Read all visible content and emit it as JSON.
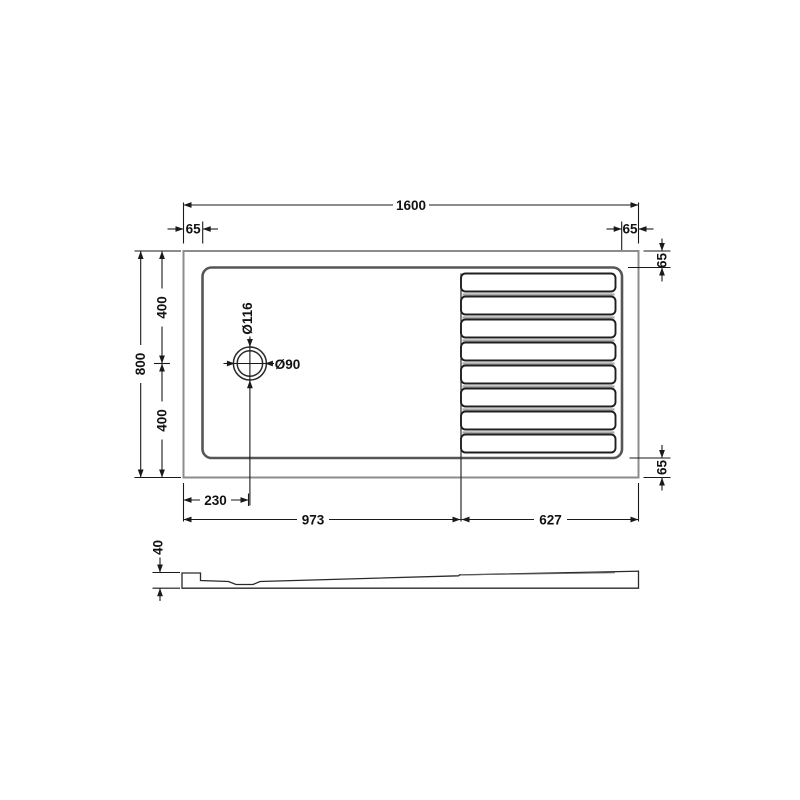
{
  "title": "Walk-in shower tray technical drawing",
  "colors": {
    "background": "#ffffff",
    "outer_edge": "#8c8c8c",
    "inner_edge": "#565656",
    "linework": "#1f1f1f",
    "dimension": "#1a1a1a",
    "slat_shading": "#a8a8a8"
  },
  "top_view": {
    "overall_width_label": "1600",
    "left_rim_label": "65",
    "right_rim_label": "65",
    "top_right_rim_label": "65",
    "bottom_right_rim_label": "65",
    "overall_depth_label": "800",
    "upper_depth_label": "400",
    "lower_depth_label": "400",
    "drain_offset_label": "230",
    "showering_zone_label": "973",
    "drying_zone_label": "627",
    "drain_outer_label": "Ø116",
    "drain_inner_label": "Ø90",
    "slat_count": 8
  },
  "side_view": {
    "height_label": "40"
  }
}
